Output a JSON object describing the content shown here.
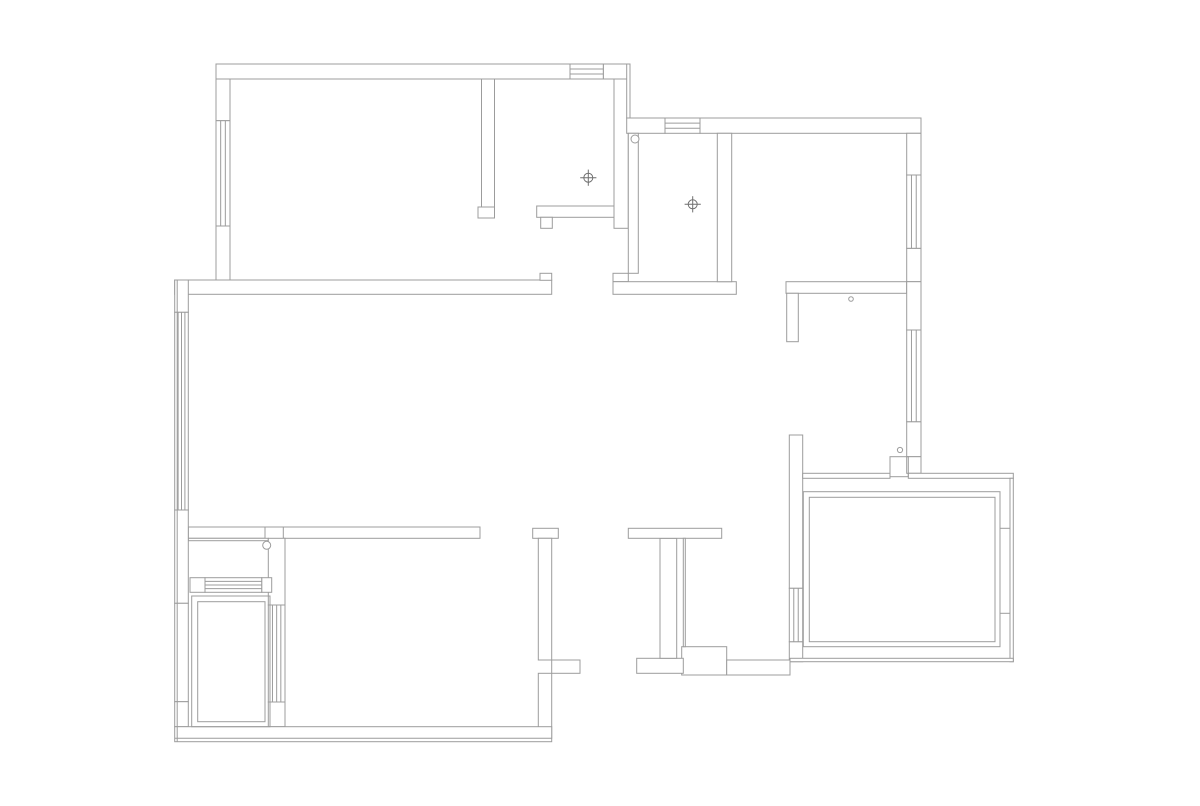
{
  "canvas": {
    "width": 1200,
    "height": 806,
    "background": "#ffffff"
  },
  "plan": {
    "stroke_color": "#9c9c9c",
    "stroke_width": 1,
    "wall_fill": "#ffffff",
    "walls": [
      {
        "x": 216,
        "y": 64,
        "w": 354,
        "h": 15
      },
      {
        "x": 603.3,
        "y": 64,
        "w": 26.7,
        "h": 15
      },
      {
        "x": 216,
        "y": 79,
        "w": 14,
        "h": 41.7
      },
      {
        "x": 216,
        "y": 226,
        "w": 14,
        "h": 54
      },
      {
        "x": 481.5,
        "y": 79,
        "w": 13,
        "h": 128
      },
      {
        "x": 478,
        "y": 207,
        "w": 16.5,
        "h": 11
      },
      {
        "x": 536.7,
        "y": 206,
        "w": 77.3,
        "h": 11.3
      },
      {
        "x": 540.7,
        "y": 217.3,
        "w": 11.6,
        "h": 11
      },
      {
        "x": 614,
        "y": 79,
        "w": 14.3,
        "h": 149.3
      },
      {
        "x": 626.7,
        "y": 64,
        "w": 3.3,
        "h": 54
      },
      {
        "x": 174.7,
        "y": 280,
        "w": 377,
        "h": 14.3
      },
      {
        "x": 540,
        "y": 273.3,
        "w": 11.7,
        "h": 7
      },
      {
        "x": 613,
        "y": 273.3,
        "w": 15.3,
        "h": 8.4
      },
      {
        "x": 613,
        "y": 281.7,
        "w": 123.3,
        "h": 12.6
      },
      {
        "x": 786,
        "y": 281.7,
        "w": 120.7,
        "h": 11.6
      },
      {
        "x": 626.7,
        "y": 118,
        "w": 38.3,
        "h": 15.3
      },
      {
        "x": 700,
        "y": 118,
        "w": 221,
        "h": 15.3
      },
      {
        "x": 906.7,
        "y": 133.3,
        "w": 14.3,
        "h": 41.7
      },
      {
        "x": 906.7,
        "y": 248.3,
        "w": 14.3,
        "h": 33.4
      },
      {
        "x": 906.7,
        "y": 281.7,
        "w": 14.3,
        "h": 48.3
      },
      {
        "x": 906.7,
        "y": 421.7,
        "w": 14.3,
        "h": 35
      },
      {
        "x": 906.7,
        "y": 456.7,
        "w": 14.3,
        "h": 16.6
      },
      {
        "x": 628.3,
        "y": 133.3,
        "w": 10,
        "h": 140
      },
      {
        "x": 717.3,
        "y": 133.3,
        "w": 14.4,
        "h": 148.4
      },
      {
        "x": 786.7,
        "y": 293.3,
        "w": 11.6,
        "h": 48.4
      },
      {
        "x": 789.3,
        "y": 435,
        "w": 13.4,
        "h": 153.3
      },
      {
        "x": 789.3,
        "y": 641.7,
        "w": 13.4,
        "h": 20
      },
      {
        "x": 802.7,
        "y": 473.3,
        "w": 87.3,
        "h": 5
      },
      {
        "x": 908.3,
        "y": 473.3,
        "w": 105,
        "h": 5
      },
      {
        "x": 1010,
        "y": 478.3,
        "w": 3.3,
        "h": 183.4
      },
      {
        "x": 790,
        "y": 658.3,
        "w": 223.3,
        "h": 3.4
      },
      {
        "x": 681.7,
        "y": 646.7,
        "w": 45,
        "h": 28.3
      },
      {
        "x": 726.7,
        "y": 660,
        "w": 63.3,
        "h": 15
      },
      {
        "x": 636.7,
        "y": 658.3,
        "w": 46.6,
        "h": 15
      },
      {
        "x": 660,
        "y": 538.3,
        "w": 16.7,
        "h": 120
      },
      {
        "x": 628.3,
        "y": 528.3,
        "w": 93.4,
        "h": 10
      },
      {
        "x": 683.3,
        "y": 538.3,
        "w": 2,
        "h": 108.4
      },
      {
        "x": 532.7,
        "y": 528.3,
        "w": 25.6,
        "h": 10
      },
      {
        "x": 538.3,
        "y": 538.3,
        "w": 13.4,
        "h": 121.7
      },
      {
        "x": 551.7,
        "y": 660,
        "w": 28.3,
        "h": 13.3
      },
      {
        "x": 538.3,
        "y": 673.3,
        "w": 13.4,
        "h": 65
      },
      {
        "x": 188.3,
        "y": 527,
        "w": 76.7,
        "h": 11.3
      },
      {
        "x": 283.3,
        "y": 527,
        "w": 196.7,
        "h": 11.3
      },
      {
        "x": 188.3,
        "y": 538.3,
        "w": 80,
        "h": 2.4
      },
      {
        "x": 268.3,
        "y": 538.3,
        "w": 16.7,
        "h": 66.7
      },
      {
        "x": 268.3,
        "y": 702,
        "w": 16.7,
        "h": 24.7
      },
      {
        "x": 190,
        "y": 577.7,
        "w": 15,
        "h": 14.6
      },
      {
        "x": 261.7,
        "y": 577.7,
        "w": 10,
        "h": 14.6
      },
      {
        "x": 174.7,
        "y": 280,
        "w": 13.6,
        "h": 32.3
      },
      {
        "x": 174.7,
        "y": 510,
        "w": 13.6,
        "h": 93.3
      },
      {
        "x": 174.7,
        "y": 603.3,
        "w": 13.6,
        "h": 98.4
      },
      {
        "x": 174.7,
        "y": 701.7,
        "w": 13.6,
        "h": 25
      },
      {
        "x": 174.7,
        "y": 726.7,
        "w": 377,
        "h": 15
      }
    ],
    "windows": [
      {
        "x": 216,
        "y": 120.7,
        "w": 14,
        "h": 105.3,
        "dir": "v",
        "n": 2
      },
      {
        "x": 174.7,
        "y": 312.3,
        "w": 13.6,
        "h": 197.7,
        "dir": "v",
        "n": 3
      },
      {
        "x": 570,
        "y": 64,
        "w": 33.3,
        "h": 15,
        "dir": "h",
        "n": 2
      },
      {
        "x": 665,
        "y": 118,
        "w": 35,
        "h": 15.3,
        "dir": "h",
        "n": 2
      },
      {
        "x": 906.7,
        "y": 175,
        "w": 14.3,
        "h": 73.3,
        "dir": "v",
        "n": 2
      },
      {
        "x": 906.7,
        "y": 330,
        "w": 14.3,
        "h": 91.7,
        "dir": "v",
        "n": 2
      },
      {
        "x": 789.3,
        "y": 588.3,
        "w": 13.4,
        "h": 53.4,
        "dir": "v",
        "n": 2
      },
      {
        "x": 205,
        "y": 577.7,
        "w": 56.7,
        "h": 14.6,
        "dir": "h",
        "n": 3
      },
      {
        "x": 268.3,
        "y": 605,
        "w": 16.7,
        "h": 97,
        "dir": "v",
        "n": 3
      }
    ],
    "outlines": [
      {
        "x": 890,
        "y": 456.7,
        "w": 18.3,
        "h": 20
      },
      {
        "x": 191.7,
        "y": 596,
        "w": 78.3,
        "h": 130.7
      },
      {
        "x": 197.7,
        "y": 601.7,
        "w": 67.3,
        "h": 120
      },
      {
        "x": 803.3,
        "y": 491.7,
        "w": 196.7,
        "h": 155
      },
      {
        "x": 809.3,
        "y": 497.3,
        "w": 185.7,
        "h": 144.4
      }
    ],
    "lines": [
      {
        "x1": 265,
        "y1": 527,
        "x2": 283.3,
        "y2": 527
      },
      {
        "x1": 1000,
        "y1": 528.3,
        "x2": 1010,
        "y2": 528.3
      },
      {
        "x1": 1000,
        "y1": 613.3,
        "x2": 1010,
        "y2": 613.3
      },
      {
        "x1": 174.7,
        "y1": 738.3,
        "x2": 551.7,
        "y2": 738.3
      },
      {
        "x1": 177.2,
        "y1": 280,
        "x2": 177.2,
        "y2": 741.7
      }
    ],
    "pivot_circles": [
      {
        "cx": 635,
        "cy": 139,
        "r": 4
      },
      {
        "cx": 266.7,
        "cy": 545.3,
        "r": 4
      },
      {
        "cx": 851,
        "cy": 299,
        "r": 2.3
      },
      {
        "cx": 900,
        "cy": 450,
        "r": 2.6
      }
    ],
    "drain_symbols": [
      {
        "cx": 588.3,
        "cy": 177.7,
        "r": 4.5
      },
      {
        "cx": 692.7,
        "cy": 204.3,
        "r": 4.5
      }
    ]
  }
}
